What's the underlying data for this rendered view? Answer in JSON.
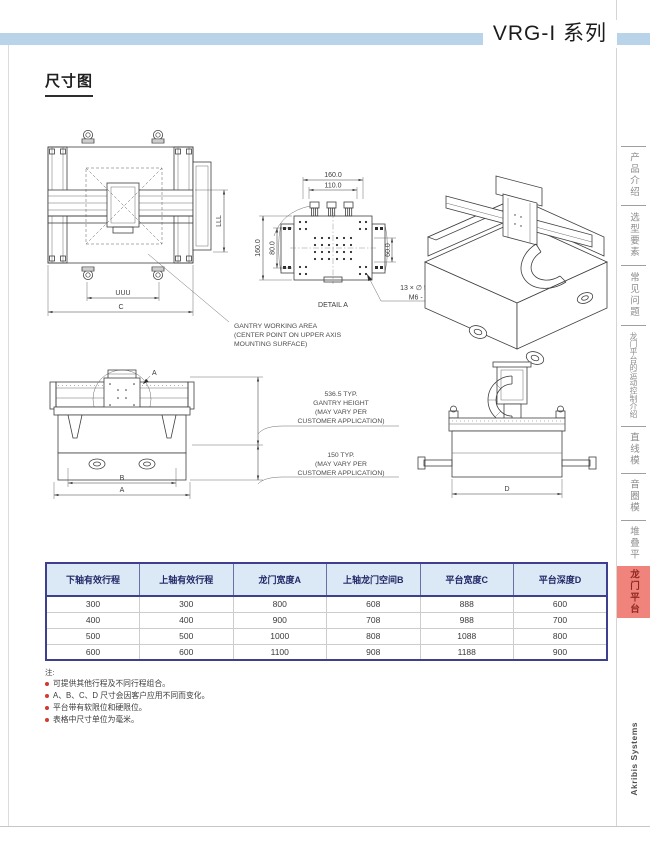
{
  "header": {
    "series_title": "VRG-I 系列",
    "section_title": "尺寸图"
  },
  "sidebar": {
    "tabs": [
      {
        "label": "产品介绍",
        "active": false
      },
      {
        "label": "选型要素",
        "active": false
      },
      {
        "label": "常见问题",
        "active": false
      },
      {
        "label": "龙门平台的运动控制介绍",
        "active": false
      },
      {
        "label": "直线模组",
        "active": false
      },
      {
        "label": "音圈模组",
        "active": false
      },
      {
        "label": "堆叠平台",
        "active": false
      },
      {
        "label": "龙门平台",
        "active": true
      }
    ],
    "brand": "Akribis Systems"
  },
  "drawings": {
    "top_view": {
      "dim_working_width": "UUU",
      "dim_platform_width": "C",
      "dim_working_depth": "LLL"
    },
    "detail_a": {
      "label": "DETAIL A",
      "dim_top_outer": "160.0",
      "dim_top_inner": "110.0",
      "dim_left_outer": "160.0",
      "dim_left_inner": "80.0",
      "dim_right": "60.0",
      "hole_callout_line1": "13 × ∅ 5.0  ↧ 15.0",
      "hole_callout_line2": "M6 - 6H  ↧ 12.0"
    },
    "front_view": {
      "dim_inner": "B",
      "dim_outer": "A",
      "detail_marker": "A"
    },
    "side_view": {
      "dim_depth": "D"
    },
    "working_area_note": [
      "GANTRY WORKING AREA",
      "(CENTER POINT ON UPPER AXIS",
      "MOUNTING SURFACE)"
    ],
    "gantry_height_note": [
      "536.5 TYP.",
      "GANTRY HEIGHT",
      "(MAY VARY PER",
      "CUSTOMER APPLICATION)"
    ],
    "base_height_note": [
      "150 TYP.",
      "(MAY VARY PER",
      "CUSTOMER APPLICATION)"
    ]
  },
  "table": {
    "headers": [
      "下轴有效行程",
      "上轴有效行程",
      "龙门宽度A",
      "上轴龙门空间B",
      "平台宽度C",
      "平台深度D"
    ],
    "rows": [
      [
        "300",
        "300",
        "800",
        "608",
        "888",
        "600"
      ],
      [
        "400",
        "400",
        "900",
        "708",
        "988",
        "700"
      ],
      [
        "500",
        "500",
        "1000",
        "808",
        "1088",
        "800"
      ],
      [
        "600",
        "600",
        "1100",
        "908",
        "1188",
        "900"
      ]
    ]
  },
  "notes": {
    "label": "注:",
    "items": [
      "可提供其他行程及不同行程组合。",
      "A、B、C、D 尺寸会因客户应用不同而变化。",
      "平台带有软限位和硬限位。",
      "表格中尺寸单位为毫米。"
    ]
  },
  "colors": {
    "band_blue": "#b9d3e8",
    "table_header_bg": "#dbe8f5",
    "table_header_text": "#232a68",
    "table_border": "#3f3f8f",
    "active_tab_bg": "#f0837c",
    "active_tab_text": "#8f2a22",
    "bullet_red": "#d03a30"
  }
}
